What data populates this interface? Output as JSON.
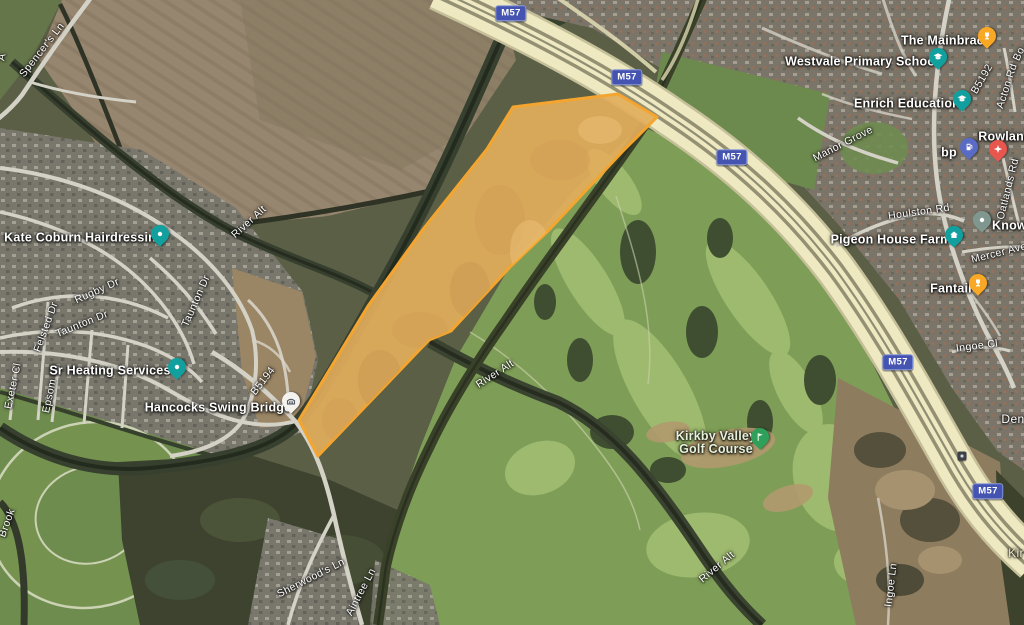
{
  "map": {
    "type": "satellite-with-parcel-overlay",
    "colors": {
      "parcel_fill": "#E2AE5C",
      "parcel_stroke": "#F4A52F",
      "motorway": "#EFE9C1",
      "shield_bg": "#4454B0",
      "pin_teal": "#12A09E",
      "pin_orange": "#F9A825",
      "pin_red": "#E8564E",
      "pin_blue": "#5A6BC5",
      "pin_green": "#2FA05A",
      "pin_sage": "#7F978F"
    }
  },
  "roads": {
    "m57": "M57",
    "spencers_ln": "Spencer's Ln",
    "rugby_dr": "Rugby Dr",
    "taunton_dr": "Taunton Dr",
    "felsted_dr": "Felsted Dr",
    "exeter_cl": "Exeter Cl",
    "epsom_cl": "Epsom Cl",
    "b5194": "B5194",
    "b5192": "B5192",
    "sherwoods_ln": "Sherwood's Ln",
    "aintree_ln": "Aintree Ln",
    "acton_rd": "Acton Rd",
    "manor_grove": "Manor Grove",
    "houlston_rd": "Houlston Rd",
    "oatlands_rd": "Oatlands Rd",
    "mercer_ave": "Mercer Ave",
    "ingoe_cl": "Ingoe Cl",
    "ingoe_ln": "Ingoe Ln",
    "fragment_bo": "Bo",
    "fragment_av": "A"
  },
  "water": {
    "river_alt": "River Alt",
    "brook_fragment": "Brook"
  },
  "places": {
    "den_fragment": "Den",
    "kir_fragment": "Kir"
  },
  "pois": {
    "kate_coburn": {
      "label": "Kate Coburn Hairdressing"
    },
    "sr_heating": {
      "label": "Sr Heating Services"
    },
    "hancocks": {
      "label": "Hancocks Swing Bridge"
    },
    "mainbrace": {
      "label": "The Mainbrace"
    },
    "westvale": {
      "label": "Westvale Primary School"
    },
    "enrich": {
      "label": "Enrich Education"
    },
    "rowland": {
      "label": "Rowland"
    },
    "bp": {
      "label": "bp"
    },
    "pigeon": {
      "label": "Pigeon House Farm"
    },
    "knowsley": {
      "label": "Knows"
    },
    "fantail": {
      "label": "Fantail"
    },
    "golf": {
      "line1": "Kirkby Valley",
      "line2": "Golf Course"
    }
  }
}
